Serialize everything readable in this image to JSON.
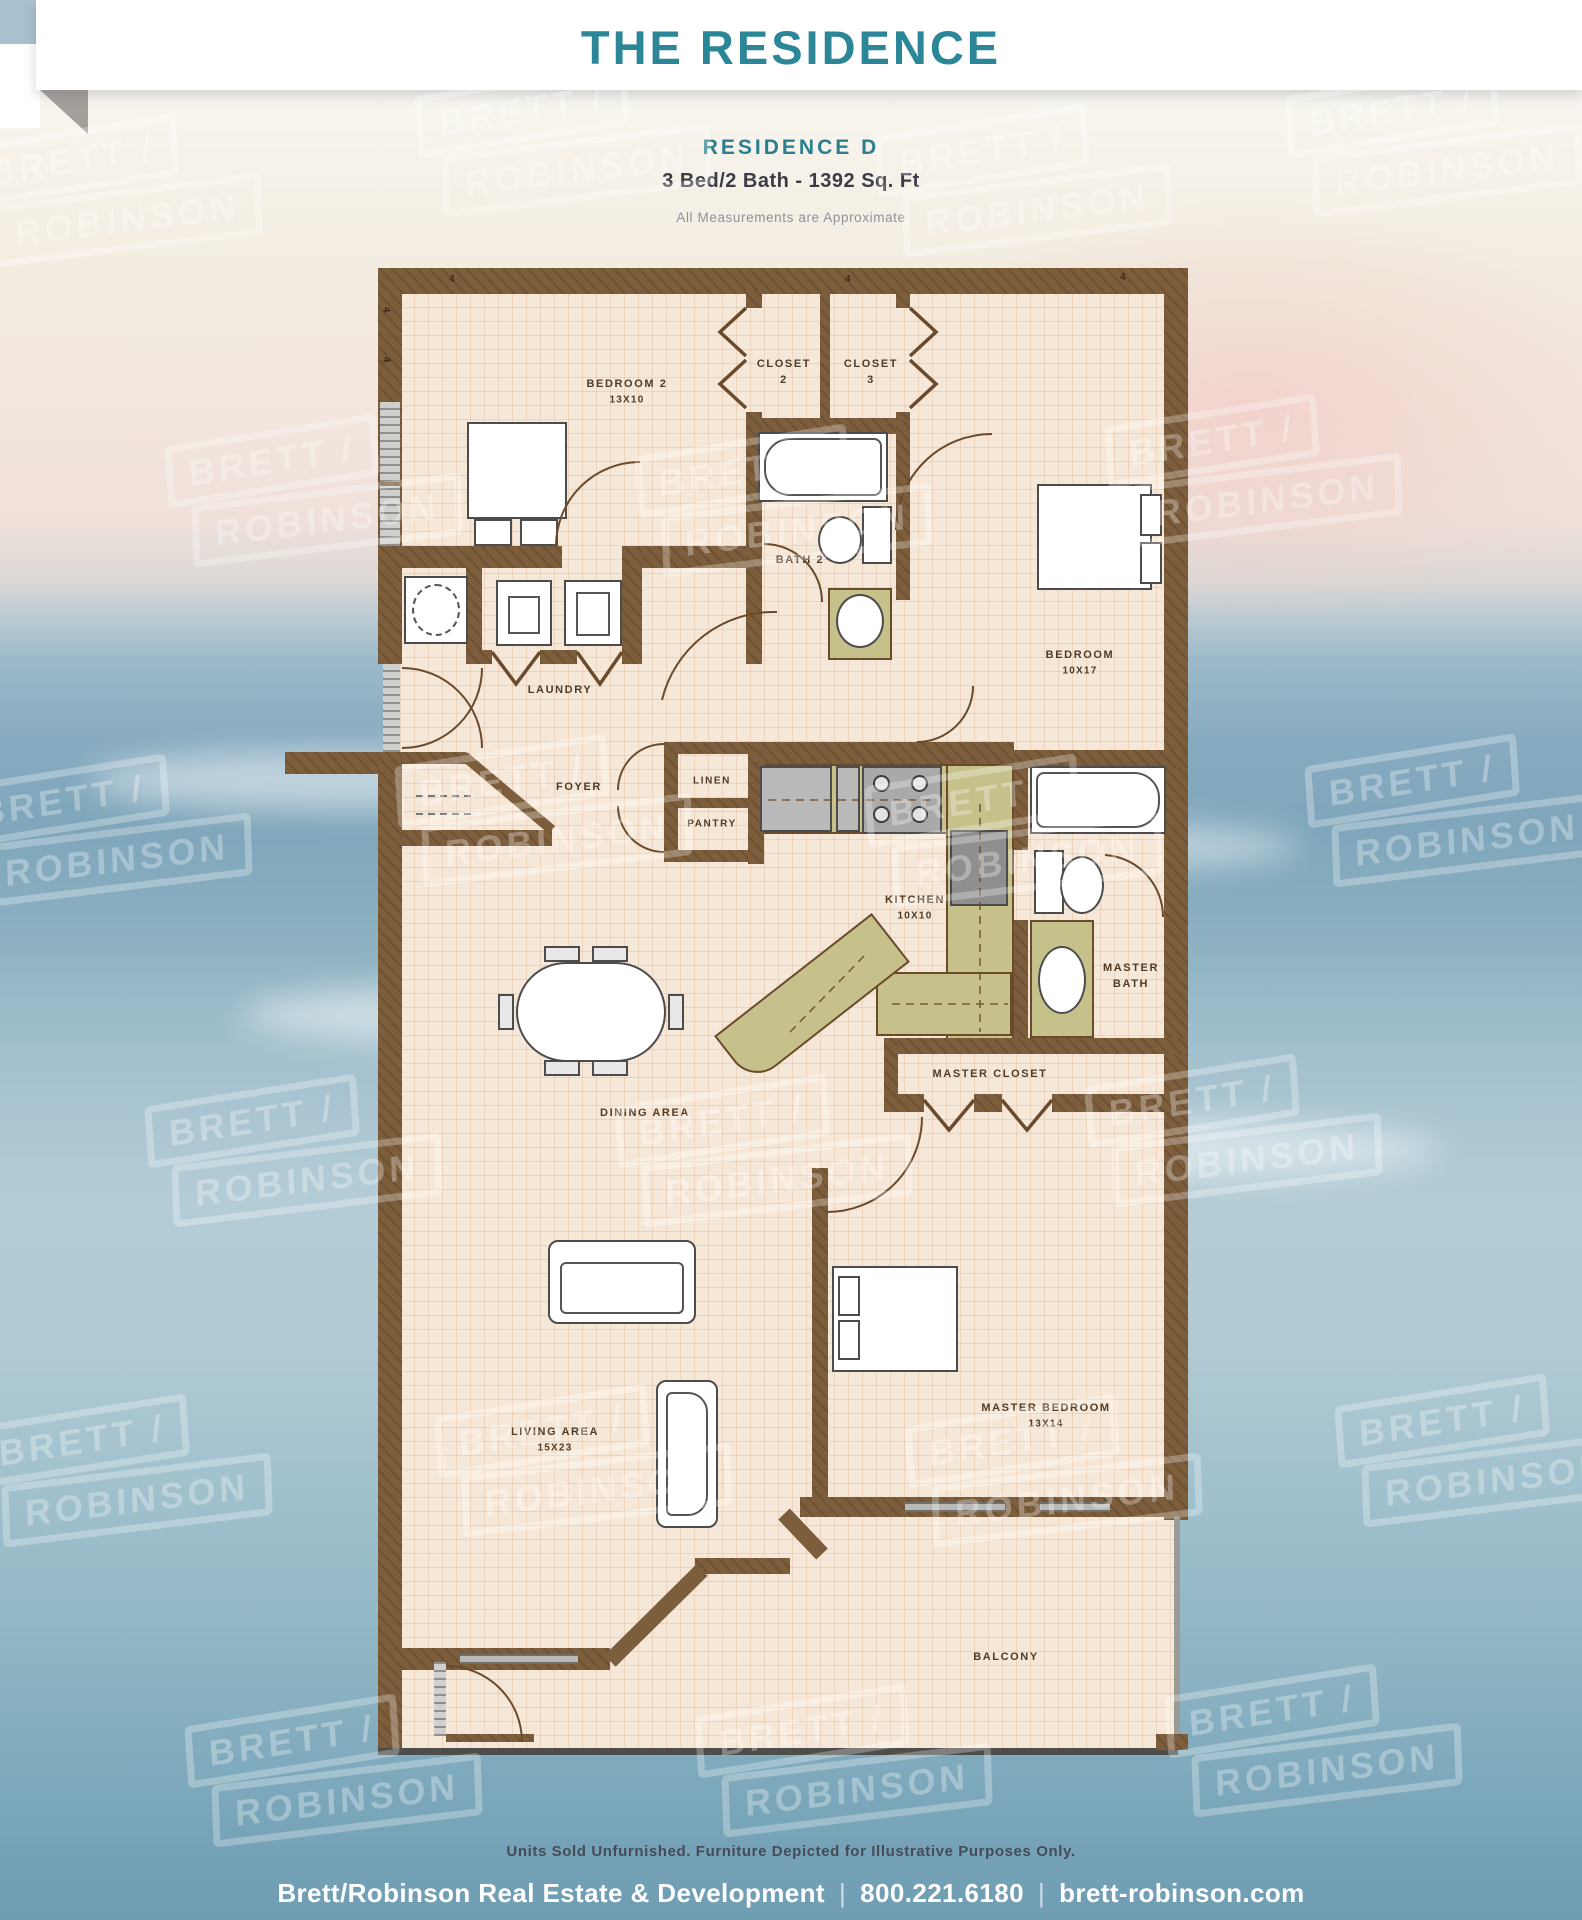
{
  "header": {
    "banner_title": "THE RESIDENCE",
    "residence_name": "RESIDENCE  D",
    "specs": "3 Bed/2 Bath - 1392 Sq. Ft",
    "disclaimer": "All Measurements are Approximate"
  },
  "watermark": {
    "line1": "BRETT /",
    "line2": "ROBINSON",
    "positions": [
      [
        -30,
        120
      ],
      [
        420,
        70
      ],
      [
        880,
        110
      ],
      [
        1290,
        70
      ],
      [
        170,
        420
      ],
      [
        640,
        430
      ],
      [
        1110,
        400
      ],
      [
        -40,
        760
      ],
      [
        400,
        740
      ],
      [
        870,
        760
      ],
      [
        1310,
        740
      ],
      [
        150,
        1080
      ],
      [
        620,
        1080
      ],
      [
        1090,
        1060
      ],
      [
        -20,
        1400
      ],
      [
        440,
        1390
      ],
      [
        910,
        1400
      ],
      [
        1340,
        1380
      ],
      [
        190,
        1700
      ],
      [
        700,
        1690
      ],
      [
        1170,
        1670
      ]
    ]
  },
  "plan": {
    "dim_mark": "4",
    "rooms": {
      "bedroom2": {
        "name": "BEDROOM 2",
        "dims": "13X10"
      },
      "closet2": {
        "line1": "CLOSET",
        "line2": "2"
      },
      "closet3": {
        "line1": "CLOSET",
        "line2": "3"
      },
      "bath2": {
        "name": "BATH 2"
      },
      "bedroom": {
        "name": "BEDROOM",
        "dims": "10X17"
      },
      "laundry": {
        "name": "LAUNDRY"
      },
      "foyer": {
        "name": "FOYER"
      },
      "linen": {
        "name": "LINEN"
      },
      "pantry": {
        "name": "PANTRY"
      },
      "kitchen": {
        "name": "KITCHEN",
        "dims": "10X10"
      },
      "master_bath": {
        "line1": "MASTER",
        "line2": "BATH"
      },
      "master_closet": {
        "name": "MASTER CLOSET"
      },
      "dining": {
        "name": "DINING AREA"
      },
      "living": {
        "name": "LIVING AREA",
        "dims": "15X23"
      },
      "master_bedroom": {
        "name": "MASTER BEDROOM",
        "dims": "13X14"
      },
      "balcony": {
        "name": "BALCONY"
      }
    }
  },
  "colors": {
    "teal": "#2B8798",
    "wall_brown": "#7D5E3C",
    "floor_tan": "#F6E8D8",
    "counter_olive": "#C6C08B",
    "ocean_blue": "#7FA6BB"
  },
  "footer": {
    "disclaimer": "Units Sold Unfurnished. Furniture Depicted for Illustrative Purposes Only.",
    "company": "Brett/Robinson Real Estate & Development",
    "phone": "800.221.6180",
    "website": "brett-robinson.com",
    "separator": "|"
  }
}
